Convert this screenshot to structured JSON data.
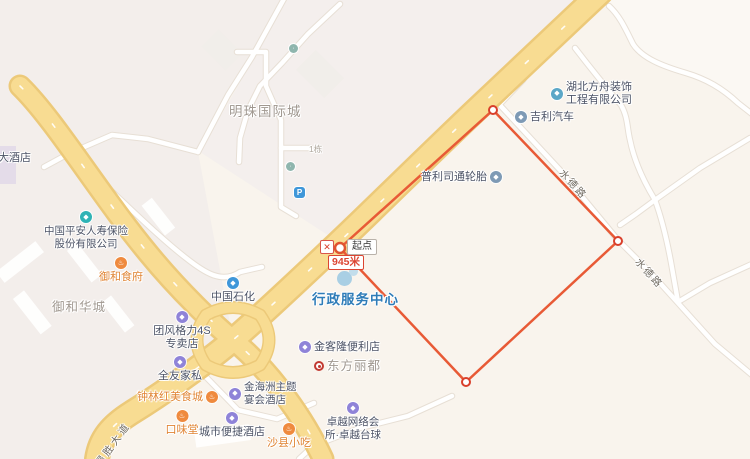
{
  "map": {
    "measurement": {
      "start_label": "起点",
      "distance": "945米",
      "close_tooltip": "✕"
    },
    "road_labels": {
      "shuide": "水德路",
      "desheng": "得胜大道"
    },
    "area_labels": {
      "mingzhu": "明珠国际城",
      "yuhehuacheng": "御和华城",
      "building_no": "1栋"
    },
    "pois": {
      "pingan": {
        "line1": "中国平安人寿保险",
        "line2": "股份有限公司"
      },
      "shihua": {
        "text": "中国石化"
      },
      "yuhefu": {
        "text": "御和食府"
      },
      "tuanfeng": {
        "line1": "团风格力4S",
        "line2": "专卖店"
      },
      "quanyou": {
        "text": "全友家私"
      },
      "zhonglin": {
        "text": "钟林红美食城"
      },
      "kouweitang": {
        "text": "口味堂"
      },
      "chengshi": {
        "text": "城市便捷酒店"
      },
      "shaxian": {
        "text": "沙县小吃"
      },
      "jinhaizhou": {
        "line1": "金海洲主题",
        "line2": "宴会酒店"
      },
      "jinkelong": {
        "text": "金客隆便利店"
      },
      "zhuoyue": {
        "line1": "卓越网络会",
        "line2": "所·卓越台球"
      },
      "xingzheng": {
        "text": "行政服务中心"
      },
      "hubeifangzhou": {
        "line1": "湖北方舟装饰",
        "line2": "工程有限公司"
      },
      "jili": {
        "text": "吉利汽车"
      },
      "pulisitong": {
        "text": "普利司通轮胎"
      },
      "dongfanglidu": {
        "text": "东方丽都"
      },
      "jiudian": {
        "text": "大酒店"
      },
      "parking_glyph": {
        "text": "P"
      }
    },
    "colors": {
      "measure_line": "#e85a36",
      "vertex_ring": "#d93f2b",
      "road_yellow": "#f8dc92",
      "road_casing": "#ecc979",
      "poi_purple": "#8f83d8",
      "poi_orange": "#ef8a3e",
      "poi_blue": "#3f97d9",
      "gov_blue_text": "#2e7cb8"
    }
  }
}
